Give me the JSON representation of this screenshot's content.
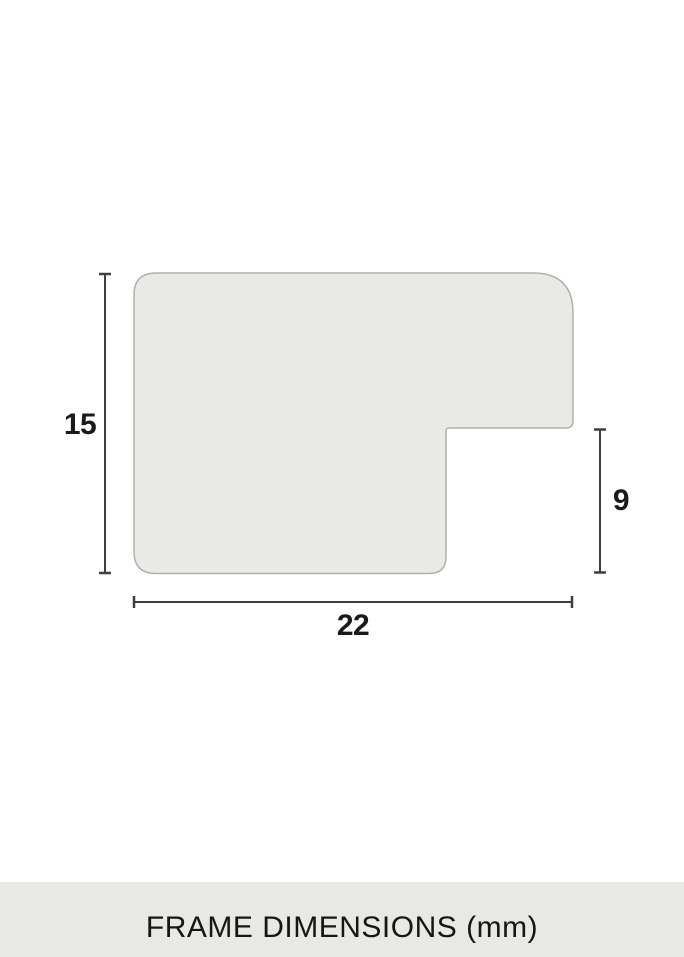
{
  "diagram": {
    "title": "frame moulding profile cross-section",
    "shape_fill": "#e9e9e5",
    "shape_stroke": "#b1b1ab",
    "line_color": "#3f3f3f",
    "label_color": "#1a1a1a",
    "dimensions": {
      "height": {
        "value": "15",
        "side": "left"
      },
      "rebate": {
        "value": "9",
        "side": "right"
      },
      "width": {
        "value": "22",
        "side": "bottom"
      }
    }
  },
  "footer": {
    "caption": "FRAME DIMENSIONS (mm)",
    "background": "#e8e8e4",
    "text_color": "#161616"
  }
}
